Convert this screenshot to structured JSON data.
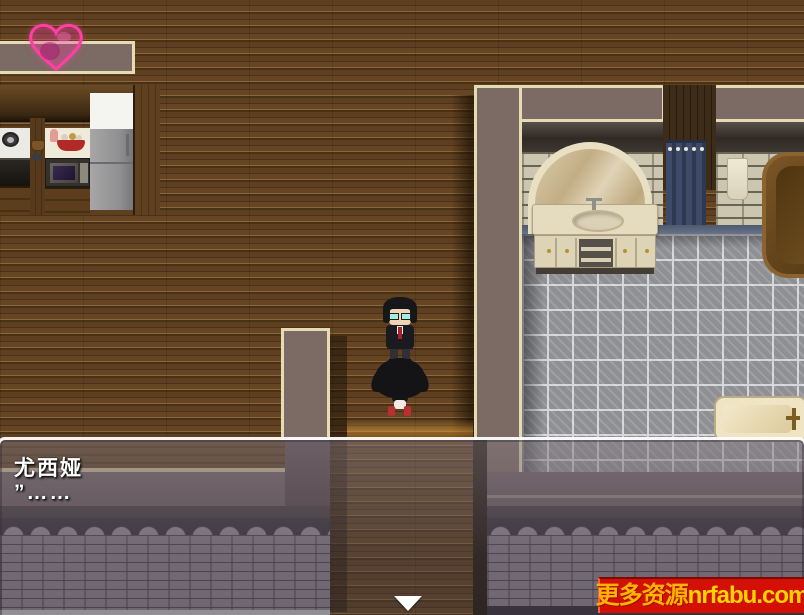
{
  "palette": {
    "wall_mauve": "#7c6a64",
    "trim_cream": "#e6dcb4",
    "tile_grey": "#8f9094",
    "heart_pink": "#ff3fa4",
    "watermark_red": "#d40f04",
    "watermark_yellow": "#ffd400",
    "dialog_text": "#ffffff"
  },
  "hud": {
    "heart_icon": "heart-icon"
  },
  "dialog": {
    "speaker": "尤西娅",
    "line": "”……",
    "continue_icon": "down-arrow"
  },
  "watermark": {
    "cn": "更多资源",
    "domain": "nrfabu.com"
  },
  "scene": {
    "characters": [
      {
        "id": "standing-character-glasses-suit"
      },
      {
        "id": "kneeling-long-hair-character"
      }
    ],
    "rooms": [
      "kitchen-living-room",
      "bathroom"
    ]
  }
}
